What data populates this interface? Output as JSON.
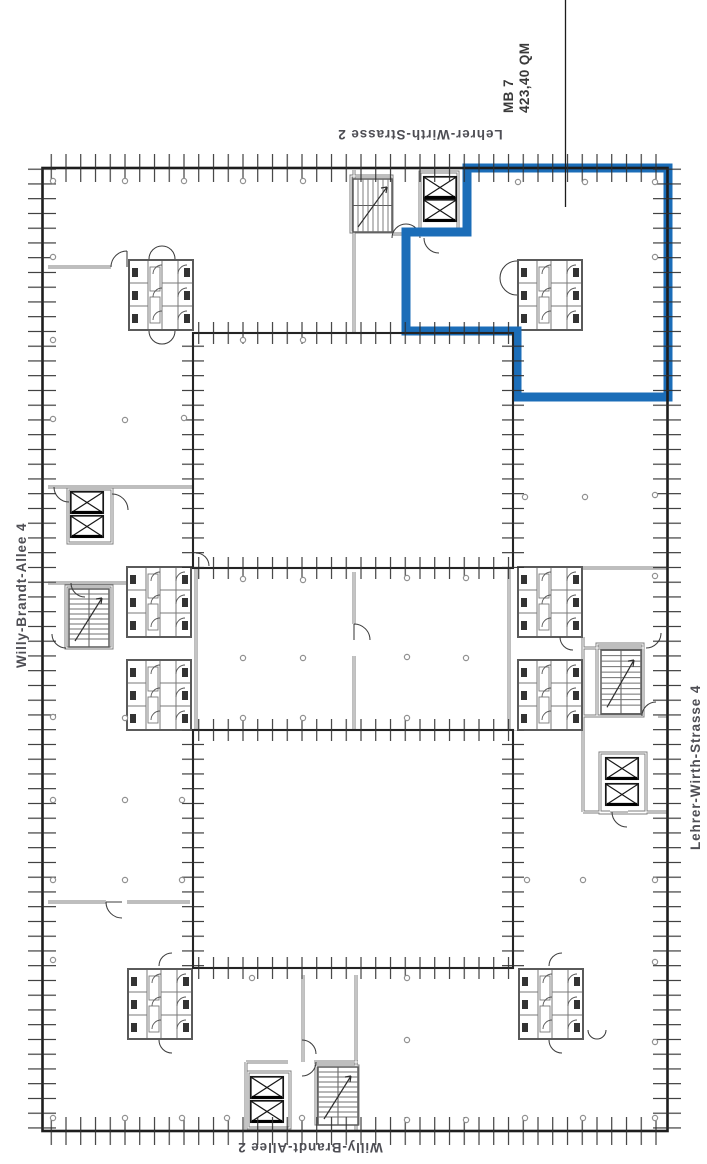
{
  "plan": {
    "streets": {
      "top": "Lehrer-Wirth-Strasse 2",
      "right": "Lehrer-Wirth-Strasse 4",
      "bottom": "Willy-Brandt-Allee 2",
      "left": "Willy-Brandt-Allee 4"
    },
    "unit": {
      "name": "MB 7",
      "area": "423,40 QM",
      "color": "#1b6db8"
    },
    "colors": {
      "walls": "#1d1d1d",
      "partitions": "#7c7c7c",
      "column_dots": "#909090",
      "label_text": "#4e4e54"
    }
  }
}
